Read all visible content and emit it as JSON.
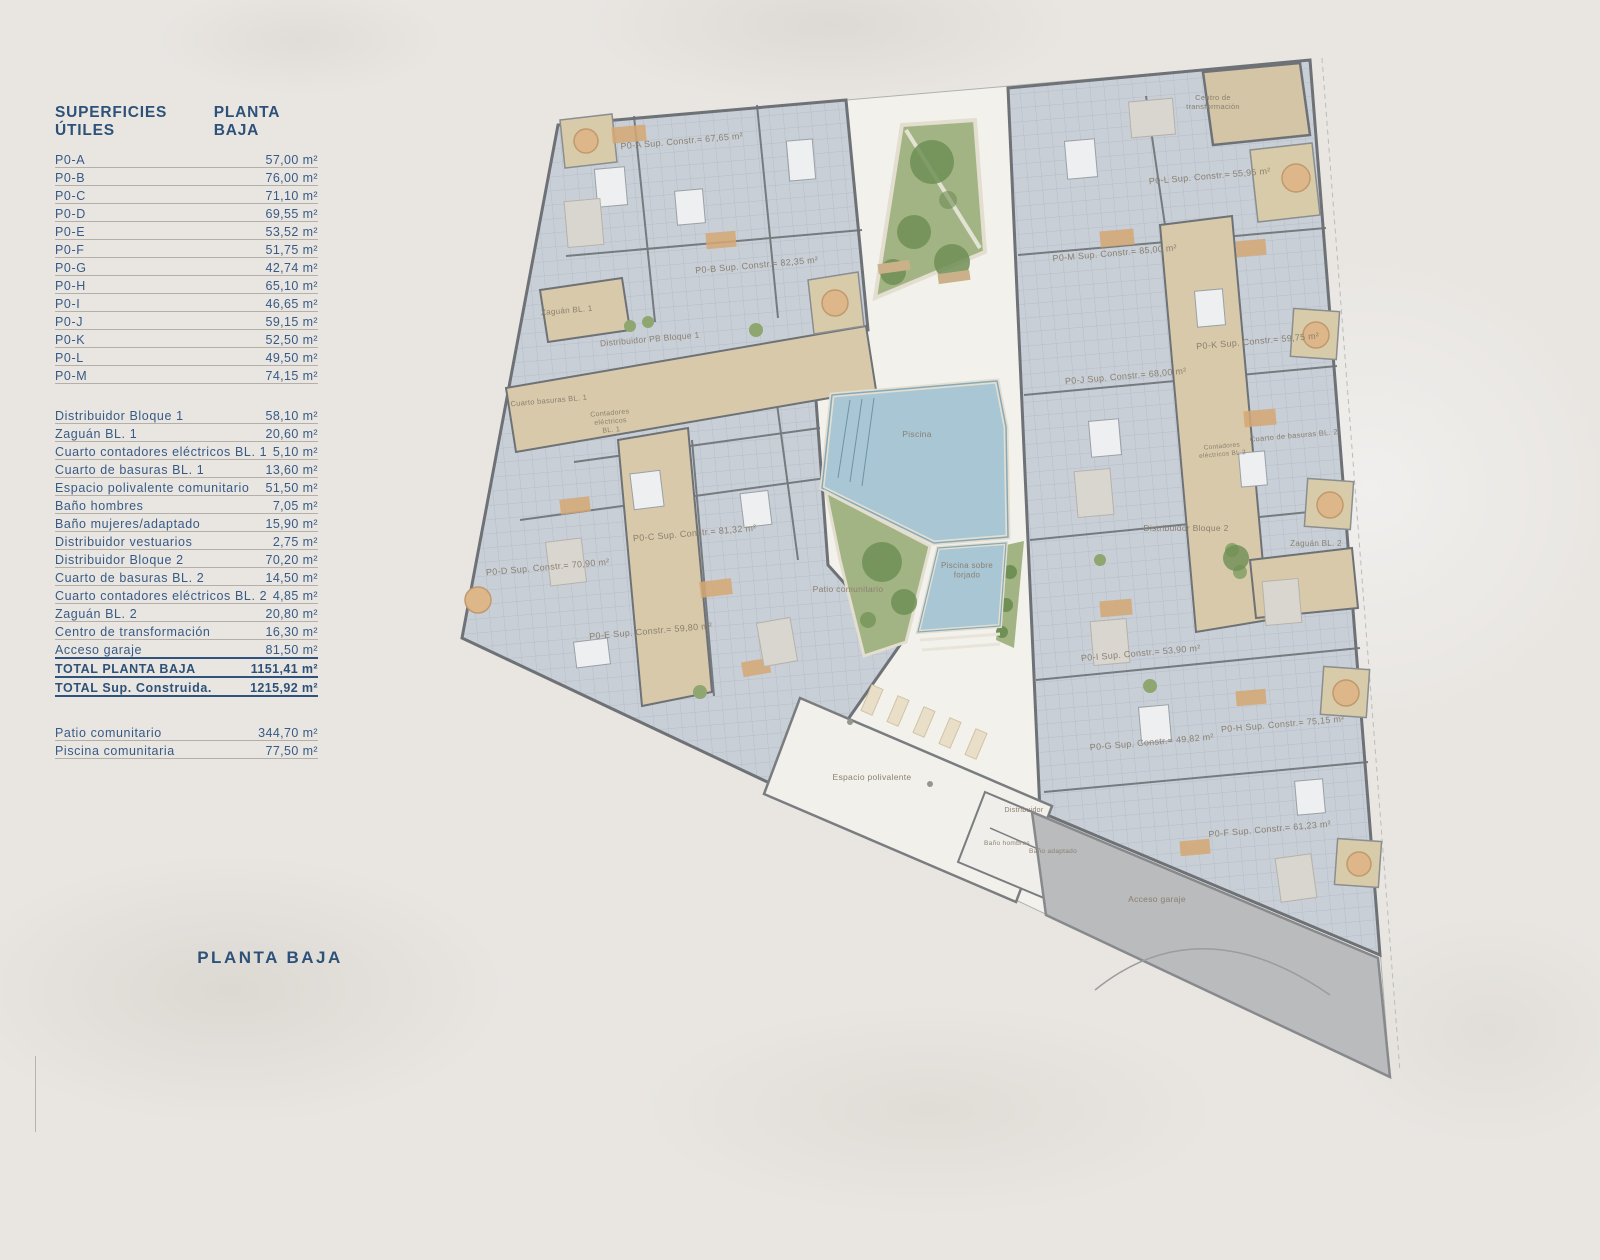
{
  "legend": {
    "title": "SUPERFICIES ÚTILES",
    "subtitle": "PLANTA BAJA",
    "units": [
      {
        "label": "P0-A",
        "value": "57,00 m²"
      },
      {
        "label": "P0-B",
        "value": "76,00 m²"
      },
      {
        "label": "P0-C",
        "value": "71,10 m²"
      },
      {
        "label": "P0-D",
        "value": "69,55 m²"
      },
      {
        "label": "P0-E",
        "value": "53,52 m²"
      },
      {
        "label": "P0-F",
        "value": "51,75 m²"
      },
      {
        "label": "P0-G",
        "value": "42,74 m²"
      },
      {
        "label": "P0-H",
        "value": "65,10 m²"
      },
      {
        "label": "P0-I",
        "value": "46,65 m²"
      },
      {
        "label": "P0-J",
        "value": "59,15 m²"
      },
      {
        "label": "P0-K",
        "value": "52,50 m²"
      },
      {
        "label": "P0-L",
        "value": "49,50 m²"
      },
      {
        "label": "P0-M",
        "value": "74,15 m²"
      }
    ],
    "commons": [
      {
        "label": "Distribuidor Bloque 1",
        "value": "58,10 m²"
      },
      {
        "label": "Zaguán BL. 1",
        "value": "20,60 m²"
      },
      {
        "label": "Cuarto contadores eléctricos BL. 1",
        "value": "5,10 m²"
      },
      {
        "label": "Cuarto de basuras BL. 1",
        "value": "13,60 m²"
      },
      {
        "label": "Espacio polivalente comunitario",
        "value": "51,50 m²"
      },
      {
        "label": "Baño hombres",
        "value": "7,05 m²"
      },
      {
        "label": "Baño mujeres/adaptado",
        "value": "15,90 m²"
      },
      {
        "label": "Distribuidor vestuarios",
        "value": "2,75 m²"
      },
      {
        "label": "Distribuidor Bloque 2",
        "value": "70,20 m²"
      },
      {
        "label": "Cuarto de basuras BL. 2",
        "value": "14,50 m²"
      },
      {
        "label": "Cuarto contadores eléctricos BL. 2",
        "value": "4,85 m²"
      },
      {
        "label": "Zaguán BL. 2",
        "value": "20,80 m²"
      },
      {
        "label": "Centro de transformación",
        "value": "16,30 m²"
      },
      {
        "label": "Acceso garaje",
        "value": "81,50 m²",
        "rule": true
      },
      {
        "label": "TOTAL PLANTA BAJA",
        "value": "1151,41 m²",
        "bold": true,
        "rule": true
      },
      {
        "label": "TOTAL Sup. Construida.",
        "value": "1215,92 m²",
        "bold": true,
        "rule": true
      }
    ],
    "outdoor": [
      {
        "label": "Patio comunitario",
        "value": "344,70 m²"
      },
      {
        "label": "Piscina comunitaria",
        "value": "77,50 m²"
      }
    ],
    "footer_label": "PLANTA BAJA"
  },
  "plan": {
    "labels": [
      {
        "text": "P0-A Sup. Constr.= 67,65 m²",
        "x": 682,
        "y": 144,
        "rot": -5,
        "size": 9
      },
      {
        "text": "P0-B Sup. Constr.= 82,35 m²",
        "x": 757,
        "y": 268,
        "rot": -5,
        "size": 9
      },
      {
        "text": "Zaguán BL. 1",
        "x": 567,
        "y": 313,
        "rot": -5,
        "size": 8
      },
      {
        "text": "Distribuidor PB Bloque 1",
        "x": 650,
        "y": 342,
        "rot": -5,
        "size": 8.5
      },
      {
        "text": "Cuarto basuras BL. 1",
        "x": 549,
        "y": 403,
        "rot": -5,
        "size": 7.5
      },
      {
        "lines": [
          "Contadores",
          "eléctricos",
          "BL. 1"
        ],
        "x": 610,
        "y": 415,
        "rot": -5,
        "size": 7
      },
      {
        "text": "P0-C Sup. Constr.= 81,32 m²",
        "x": 695,
        "y": 536,
        "rot": -5,
        "size": 9
      },
      {
        "text": "P0-D Sup. Constr.= 70,90 m²",
        "x": 548,
        "y": 570,
        "rot": -5,
        "size": 9
      },
      {
        "text": "P0-E Sup. Constr.= 59,80 m²",
        "x": 651,
        "y": 634,
        "rot": -5,
        "size": 9
      },
      {
        "text": "Piscina",
        "x": 917,
        "y": 437,
        "rot": 0,
        "size": 8.5
      },
      {
        "lines": [
          "Piscina sobre",
          "forjado"
        ],
        "x": 967,
        "y": 568,
        "rot": 0,
        "size": 8
      },
      {
        "text": "Patio comunitario",
        "x": 848,
        "y": 592,
        "rot": 0,
        "size": 8.5
      },
      {
        "text": "Espacio polivalente",
        "x": 872,
        "y": 780,
        "rot": 0,
        "size": 8.5
      },
      {
        "text": "Distribuidor",
        "x": 1024,
        "y": 812,
        "rot": 0,
        "size": 7
      },
      {
        "text": "Baño hombres",
        "x": 1007,
        "y": 845,
        "rot": 0,
        "size": 6.5
      },
      {
        "text": "Baño adaptado",
        "x": 1053,
        "y": 853,
        "rot": 0,
        "size": 6.5
      },
      {
        "lines": [
          "Centro de",
          "transformación"
        ],
        "x": 1213,
        "y": 100,
        "rot": 0,
        "size": 7.5
      },
      {
        "text": "P0-L Sup. Constr.= 55,95 m²",
        "x": 1210,
        "y": 179,
        "rot": -5,
        "size": 9
      },
      {
        "text": "P0-M Sup. Constr.= 85,00 m²",
        "x": 1115,
        "y": 256,
        "rot": -5,
        "size": 9
      },
      {
        "text": "P0-K Sup. Constr.= 59,75 m²",
        "x": 1258,
        "y": 344,
        "rot": -5,
        "size": 9
      },
      {
        "text": "P0-J Sup. Constr.= 68,00 m²",
        "x": 1126,
        "y": 379,
        "rot": -5,
        "size": 9
      },
      {
        "text": "Cuarto de basuras BL. 2",
        "x": 1294,
        "y": 438,
        "rot": -5,
        "size": 7.5
      },
      {
        "lines": [
          "Contadores",
          "eléctricos BL.2"
        ],
        "x": 1222,
        "y": 448,
        "rot": -5,
        "size": 6.5
      },
      {
        "text": "Distribuidor Bloque 2",
        "x": 1186,
        "y": 531,
        "rot": 0,
        "size": 8.5
      },
      {
        "text": "Zaguán BL. 2",
        "x": 1316,
        "y": 546,
        "rot": 0,
        "size": 8
      },
      {
        "text": "P0-I Sup. Constr.= 53,90 m²",
        "x": 1141,
        "y": 656,
        "rot": -5,
        "size": 9
      },
      {
        "text": "P0-G Sup. Constr.= 49,82 m²",
        "x": 1152,
        "y": 745,
        "rot": -5,
        "size": 9
      },
      {
        "text": "P0-H Sup. Constr.= 75,15 m²",
        "x": 1283,
        "y": 727,
        "rot": -5,
        "size": 9
      },
      {
        "text": "P0-F Sup. Constr.= 61,23 m²",
        "x": 1270,
        "y": 832,
        "rot": -5,
        "size": 9
      },
      {
        "text": "Acceso garaje",
        "x": 1157,
        "y": 902,
        "rot": 0,
        "size": 8.5
      }
    ]
  },
  "colors": {
    "navy": "#2d5178",
    "rule_gray": "#b3b0ab",
    "paper": "#f3f1ec",
    "apartment": "#c8cfd7",
    "wall": "#6e7276",
    "corridor": "#d7c9a9",
    "pool": "#a9c6d4",
    "green": "#a3b484",
    "garage": "#b9bbbd",
    "plan_text": "#8b8070"
  }
}
